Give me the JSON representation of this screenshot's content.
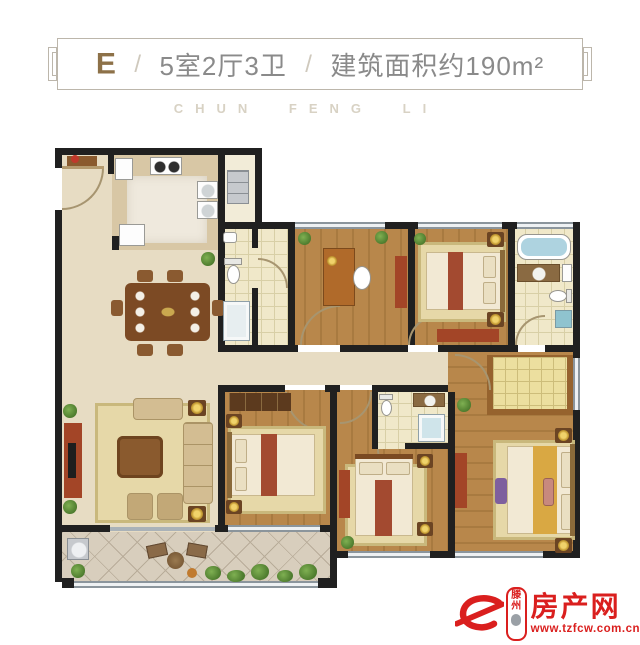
{
  "header": {
    "unit_label": "E",
    "separator": "/",
    "layout": "5室2厅3卫",
    "area": "建筑面积约190m²"
  },
  "watermark": "CHUN FENG LI",
  "logo": {
    "glyph": "e",
    "city": "滕州",
    "name": "房产网",
    "url": "www.tzfcw.com.cn"
  },
  "colors": {
    "brand_red": "#da1f1e",
    "header_gold": "#8d7148",
    "header_gray": "#8a8a8a",
    "watermark_gray": "#d8d2c4",
    "wall_black": "#202020"
  }
}
